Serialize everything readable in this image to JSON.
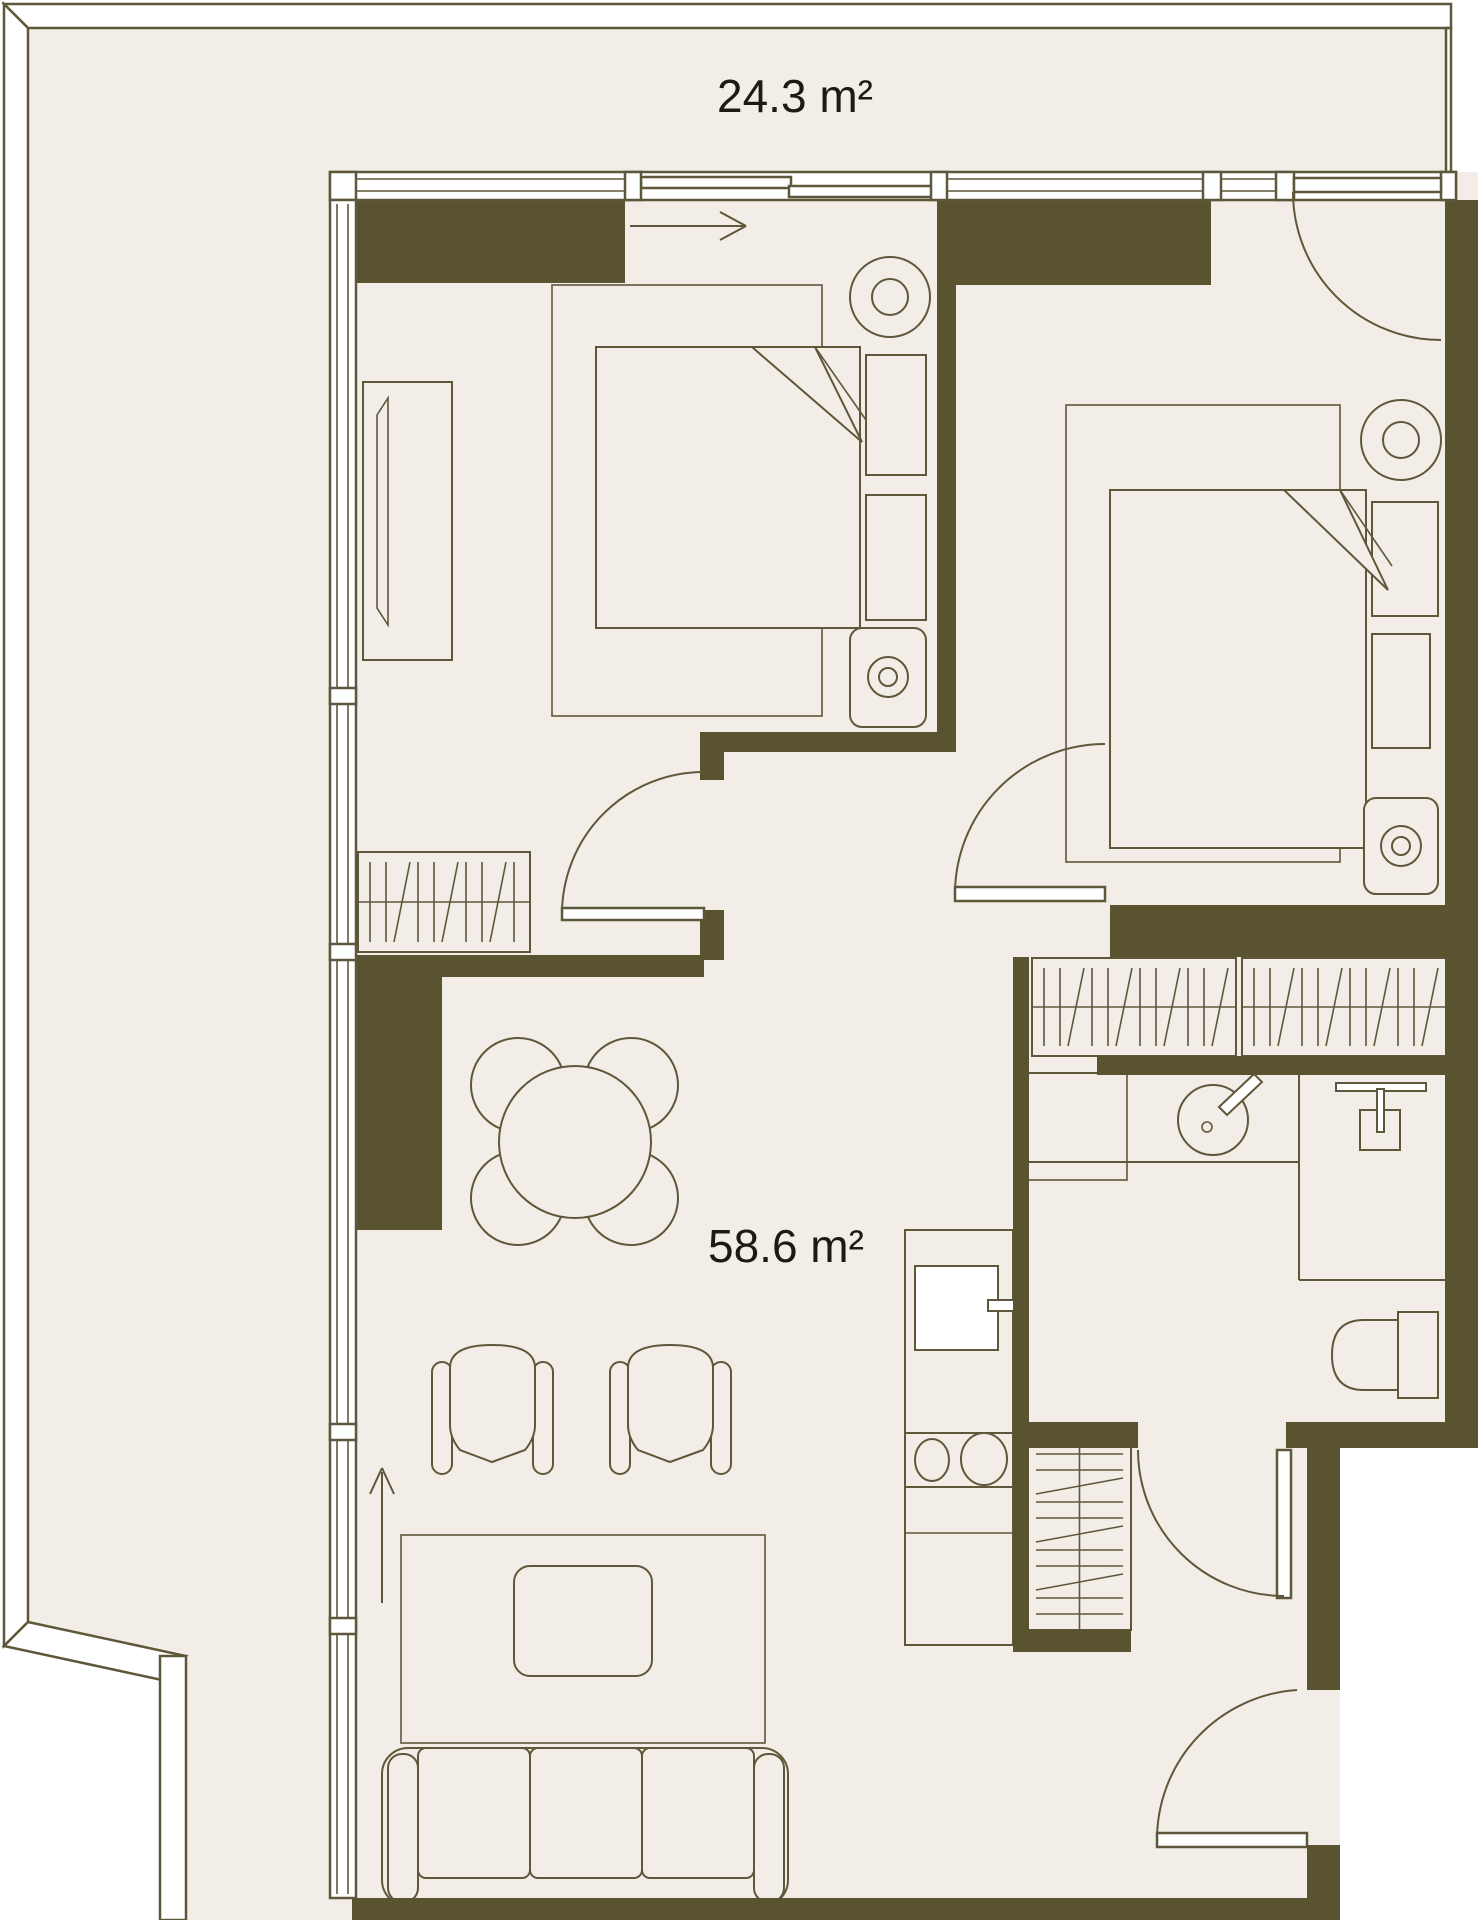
{
  "theme": {
    "bg": "#ffffff",
    "floor": "#f2eee7",
    "wall": "#5a5330",
    "line": "#5f573a",
    "text": "#1c1a15",
    "white": "#ffffff"
  },
  "labels": {
    "terrace_area": "24.3 m²",
    "apartment_area": "58.6 m²"
  },
  "icons": {
    "double-bed-icon": "mattress with pillows and folded blanket corner",
    "ceiling-lamp-icon": "two concentric circles",
    "bedside-lamp-icon": "rounded table with concentric circles",
    "wardrobe-rail-icon": "rail line with hanger ticks and zigzag",
    "dining-set-icon": "round table with four chair circles",
    "armchair-icon": "armchair seen from above",
    "sofa-icon": "three-seat sofa",
    "coffee-table-icon": "rounded rectangle table",
    "rug-icon": "thin outline rectangle",
    "oven-icon": "square with handle",
    "cooktop-icon": "two burner circles",
    "sink-basin-icon": "circle with tap bar",
    "shower-icon": "T-bar with floor drain square",
    "toilet-icon": "bowl with cistern",
    "door-swing-icon": "quarter-circle arc with leaf",
    "direction-arrow-icon": "straight arrow"
  }
}
